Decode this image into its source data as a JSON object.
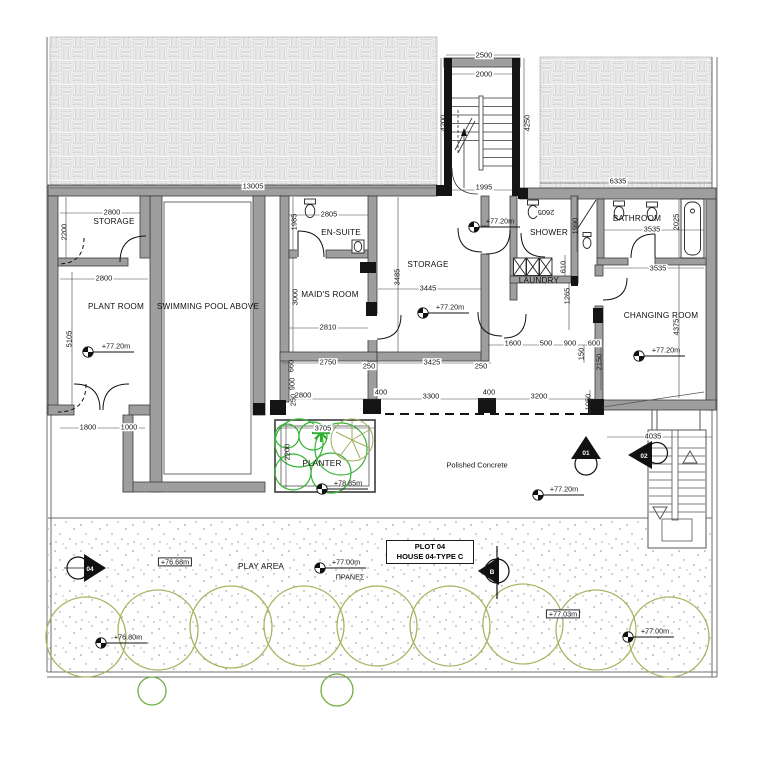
{
  "rooms": {
    "storage_left": "STORAGE",
    "plant_room": "PLANT ROOM",
    "swimming_pool": "SWIMMING POOL ABOVE",
    "en_suite": "EN-SUITE",
    "maids_room": "MAID'S ROOM",
    "storage_center": "STORAGE",
    "shower": "SHOWER",
    "laundry": "LAUNDRY",
    "bathroom": "BATHROOM",
    "changing_room": "CHANGING ROOM"
  },
  "areas": {
    "planter": "PLANTER",
    "polished_concrete": "Polished Concrete",
    "play_area": "PLAY AREA",
    "pranes": "ΠΡΑΝΕΣ"
  },
  "dimensions": {
    "d2500": "2500",
    "d2000": "2000",
    "d4200": "4200",
    "d4250": "4250",
    "d1995": "1995",
    "d13005": "13005",
    "d6335": "6335",
    "d2800_storage": "2800",
    "d2200_storage": "2200",
    "d2800_plant": "2800",
    "d5105": "5105",
    "d1800": "1800",
    "d1000": "1000",
    "d2805": "2805",
    "d1985": "1985",
    "d3000": "3000",
    "d2810": "2810",
    "d2750": "2750",
    "d250_a": "250",
    "d3485": "3485",
    "d3445": "3445",
    "d3425": "3425",
    "d250_b": "250",
    "d2605": "2605",
    "d1990": "1990",
    "d610": "610",
    "d1265": "1265",
    "d3535_a": "3535",
    "d2025": "2025",
    "d3535_b": "3535",
    "d4375": "4375",
    "d4035": "4035",
    "d1600": "1600",
    "d500": "500",
    "d900": "900",
    "d600": "600",
    "d150": "150",
    "d2150": "2150",
    "d3200": "3200",
    "d1050": "1050",
    "d2800_b": "2800",
    "d400_a": "400",
    "d3300": "3300",
    "d400_b": "400",
    "d660": "660",
    "d900_b": "900",
    "d250_c": "250",
    "d3705": "3705",
    "d2200_planter": "2200"
  },
  "levels": {
    "l7720": "+77.20m",
    "l7885": "+78.85m",
    "l7668": "+76.68m",
    "l7700": "+77.00m",
    "l7680": "+76.80m",
    "l7703": "+77.03m"
  },
  "markers": {
    "m01": "01",
    "m02": "02",
    "m04": "04",
    "mB": "B"
  },
  "plot_box": {
    "line1": "PLOT 04",
    "line2": "HOUSE 04-TYPE C"
  },
  "colors": {
    "wall_gray": "#9e9e9e",
    "black": "#141414",
    "planter_green": "#35b235",
    "hedge_olive": "#a9b463",
    "paving_line": "#c9c9c9"
  }
}
